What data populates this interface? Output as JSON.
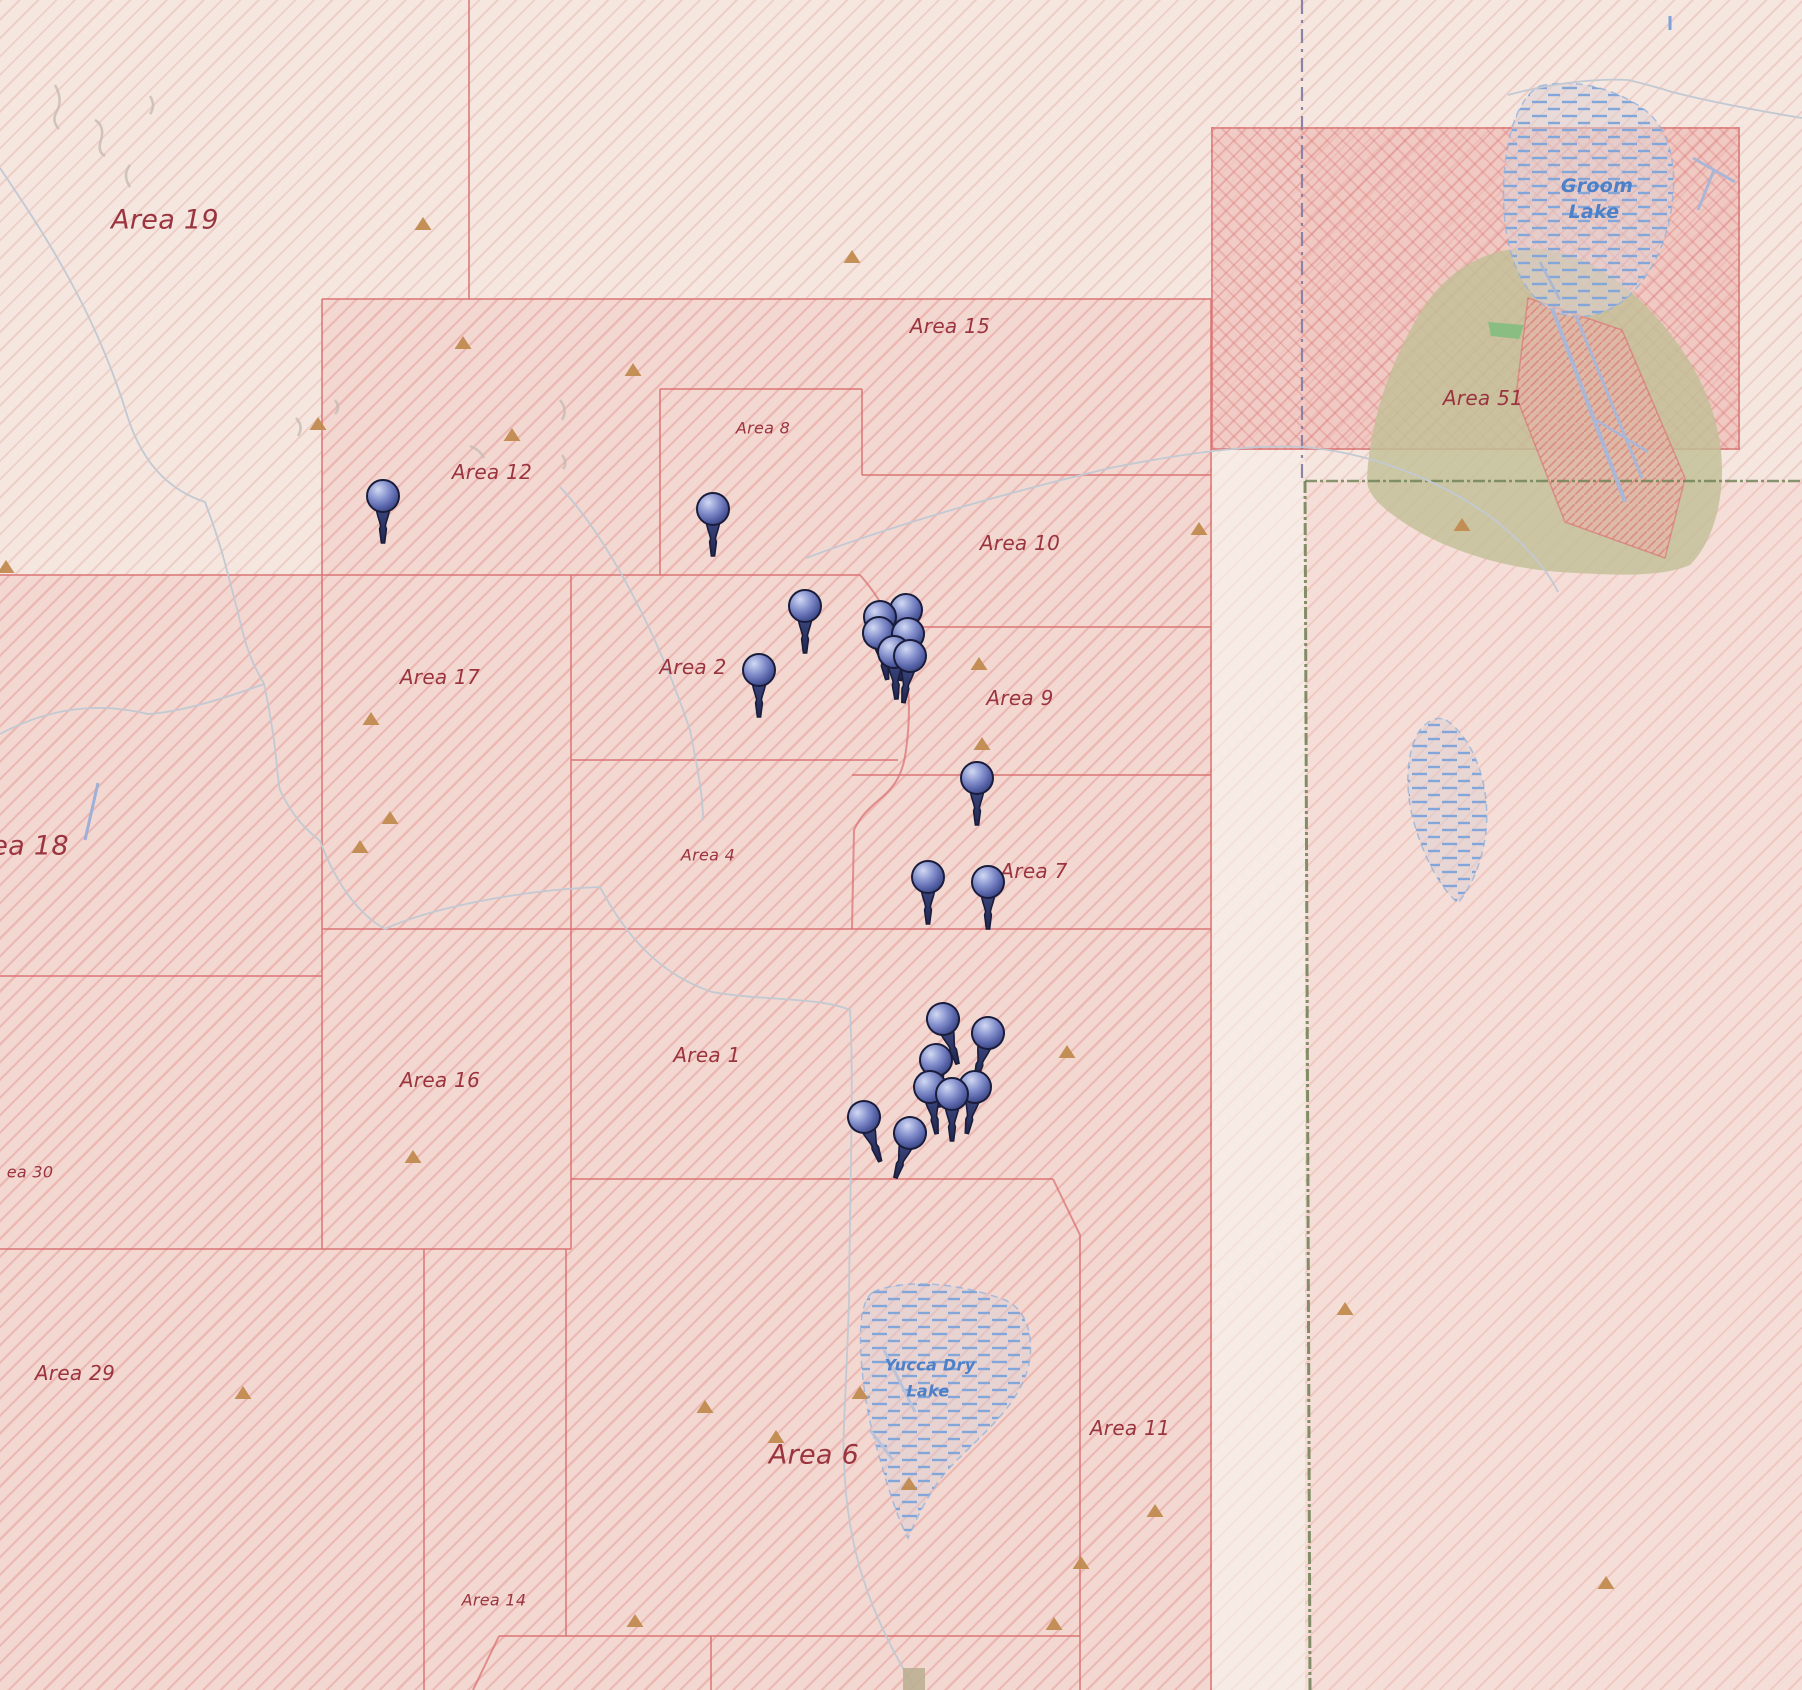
{
  "map": {
    "width": 1802,
    "height": 1690,
    "colors": {
      "label_red": "#9a343f",
      "label_blue": "#4c80c8",
      "border_red": "rgba(216,112,112,0.72)",
      "peak": "#c18b4f",
      "pin_body": "#6b77bb",
      "green_boundary": "#6d7f53",
      "county_boundary": "#8d81a4",
      "road": "#c2c9d2",
      "runway": "#aab6d6",
      "olive_base": "#c2bf97",
      "lake_dash": "#83a6da",
      "squiggle": "#c6bcb2"
    },
    "labels": [
      {
        "id": "area-19",
        "text": "Area 19",
        "x": 165,
        "y": 220,
        "size": "xl",
        "color": "red"
      },
      {
        "id": "area-15",
        "text": "Area 15",
        "x": 950,
        "y": 326,
        "size": "md",
        "color": "red"
      },
      {
        "id": "area-8",
        "text": "Area 8",
        "x": 763,
        "y": 428,
        "size": "sm",
        "color": "red"
      },
      {
        "id": "area-12",
        "text": "Area 12",
        "x": 492,
        "y": 472,
        "size": "md",
        "color": "red"
      },
      {
        "id": "area-51",
        "text": "Area 51",
        "x": 1483,
        "y": 398,
        "size": "md",
        "color": "red"
      },
      {
        "id": "groom-lake-line1",
        "text": "Groom",
        "x": 1597,
        "y": 186,
        "size": "blue-md",
        "color": "blue"
      },
      {
        "id": "groom-lake-line2",
        "text": "Lake",
        "x": 1594,
        "y": 212,
        "size": "blue-md",
        "color": "blue"
      },
      {
        "id": "area-10",
        "text": "Area 10",
        "x": 1020,
        "y": 543,
        "size": "md",
        "color": "red"
      },
      {
        "id": "area-2",
        "text": "Area 2",
        "x": 693,
        "y": 667,
        "size": "md",
        "color": "red"
      },
      {
        "id": "area-17",
        "text": "Area 17",
        "x": 440,
        "y": 677,
        "size": "md",
        "color": "red"
      },
      {
        "id": "area-9",
        "text": "Area 9",
        "x": 1020,
        "y": 698,
        "size": "md",
        "color": "red"
      },
      {
        "id": "area-18",
        "text": "ea 18",
        "x": 30,
        "y": 846,
        "size": "xl",
        "color": "red"
      },
      {
        "id": "area-4",
        "text": "Area 4",
        "x": 708,
        "y": 855,
        "size": "sm",
        "color": "red"
      },
      {
        "id": "area-7",
        "text": "Area 7",
        "x": 1034,
        "y": 871,
        "size": "md",
        "color": "red"
      },
      {
        "id": "area-1",
        "text": "Area 1",
        "x": 707,
        "y": 1055,
        "size": "md",
        "color": "red"
      },
      {
        "id": "area-16",
        "text": "Area 16",
        "x": 440,
        "y": 1080,
        "size": "md",
        "color": "red"
      },
      {
        "id": "area-30",
        "text": "ea 30",
        "x": 30,
        "y": 1172,
        "size": "sm",
        "color": "red"
      },
      {
        "id": "area-29",
        "text": "Area 29",
        "x": 75,
        "y": 1373,
        "size": "md",
        "color": "red"
      },
      {
        "id": "yucca-lake-line1",
        "text": "Yucca Dry",
        "x": 930,
        "y": 1365,
        "size": "blue-sm",
        "color": "blue"
      },
      {
        "id": "yucca-lake-line2",
        "text": "Lake",
        "x": 928,
        "y": 1391,
        "size": "blue-sm",
        "color": "blue"
      },
      {
        "id": "area-11",
        "text": "Area 11",
        "x": 1130,
        "y": 1428,
        "size": "md",
        "color": "red"
      },
      {
        "id": "area-6",
        "text": "Area 6",
        "x": 814,
        "y": 1455,
        "size": "xl",
        "color": "red"
      },
      {
        "id": "area-14",
        "text": "Area 14",
        "x": 494,
        "y": 1600,
        "size": "sm",
        "color": "red"
      }
    ],
    "pins": [
      {
        "x": 383,
        "y": 496,
        "rot": 0
      },
      {
        "x": 713,
        "y": 509,
        "rot": 0
      },
      {
        "x": 805,
        "y": 606,
        "rot": 0
      },
      {
        "x": 759,
        "y": 670,
        "rot": 0
      },
      {
        "x": 880,
        "y": 617,
        "rot": -6
      },
      {
        "x": 906,
        "y": 610,
        "rot": 5
      },
      {
        "x": 879,
        "y": 633,
        "rot": -10
      },
      {
        "x": 908,
        "y": 634,
        "rot": 10
      },
      {
        "x": 894,
        "y": 652,
        "rot": -3
      },
      {
        "x": 910,
        "y": 656,
        "rot": 8
      },
      {
        "x": 977,
        "y": 778,
        "rot": 0
      },
      {
        "x": 928,
        "y": 877,
        "rot": 0
      },
      {
        "x": 988,
        "y": 882,
        "rot": 0
      },
      {
        "x": 943,
        "y": 1019,
        "rot": -18
      },
      {
        "x": 988,
        "y": 1033,
        "rot": 15
      },
      {
        "x": 936,
        "y": 1060,
        "rot": -5
      },
      {
        "x": 930,
        "y": 1087,
        "rot": -8
      },
      {
        "x": 975,
        "y": 1087,
        "rot": 10
      },
      {
        "x": 952,
        "y": 1094,
        "rot": 0
      },
      {
        "x": 864,
        "y": 1117,
        "rot": -20
      },
      {
        "x": 910,
        "y": 1133,
        "rot": 18
      }
    ],
    "peaks": [
      [
        423,
        225
      ],
      [
        318,
        425
      ],
      [
        463,
        344
      ],
      [
        512,
        436
      ],
      [
        633,
        371
      ],
      [
        852,
        258
      ],
      [
        6,
        568
      ],
      [
        371,
        720
      ],
      [
        390,
        819
      ],
      [
        360,
        848
      ],
      [
        979,
        665
      ],
      [
        982,
        745
      ],
      [
        1199,
        530
      ],
      [
        1462,
        526
      ],
      [
        1067,
        1053
      ],
      [
        413,
        1158
      ],
      [
        243,
        1394
      ],
      [
        705,
        1408
      ],
      [
        776,
        1438
      ],
      [
        860,
        1394
      ],
      [
        909,
        1485
      ],
      [
        635,
        1622
      ],
      [
        1081,
        1564
      ],
      [
        1054,
        1625
      ],
      [
        1155,
        1512
      ],
      [
        1345,
        1310
      ],
      [
        1606,
        1584
      ]
    ],
    "borders": [
      "M469,0 L469,299",
      "M322,299 L1211,299",
      "M322,299 L322,1249",
      "M660,389 L862,389",
      "M660,389 L660,575",
      "M862,389 L862,475",
      "M862,475 L1211,475",
      "M0,575 L860,575",
      "M571,575 L571,1249",
      "M860,575 C900,620 916,680 906,750 C900,800 870,795 854,830 L852,929",
      "M904,627 L1211,627",
      "M852,775 L1211,775",
      "M571,760 L898,760",
      "M322,929 L1211,929",
      "M0,976 L322,976",
      "M571,1179 L1053,1179",
      "M1053,1179 L1080,1235 L1080,1690",
      "M0,1249 L571,1249",
      "M424,1249 L424,1690",
      "M566,1249 L566,1636",
      "M499,1636 L1080,1636",
      "M499,1636 L473,1690",
      "M711,1636 L711,1690",
      "M1211,299 L1211,1690"
    ],
    "boundaries": {
      "county_dash": "M1302,0 L1302,481",
      "green_vertical": "M1305,481 L1310,1690",
      "green_horizontal": "M1305,481 L1802,481"
    },
    "olive_base_area": "M1367,478 C1370,420 1390,360 1425,305 C1455,262 1500,242 1548,250 C1595,258 1640,292 1675,340 C1705,380 1722,425 1722,470 C1722,510 1710,545 1690,565 C1660,578 1610,575 1560,572 C1500,568 1440,548 1400,520 C1378,505 1366,492 1367,478 Z",
    "green_sliver": "M1488,322 L1524,325 L1519,339 L1491,336 Z",
    "runway_area": "M1528,298 L1622,330 L1685,478 L1665,558 L1565,522 L1516,396 Z",
    "runways": [
      {
        "d": "M1552,308 L1625,502",
        "w": 4
      },
      {
        "d": "M1576,316 L1642,478",
        "w": 3
      },
      {
        "d": "M1596,420 L1648,452",
        "w": 2.5
      },
      {
        "d": "M1540,262 L1560,300",
        "w": 2.5
      },
      {
        "d": "M1693,158 L1735,182",
        "w": 3
      },
      {
        "d": "M1714,170 L1698,210",
        "w": 3
      }
    ],
    "lakes": {
      "groom": "M1540,86 C1575,78 1615,88 1645,110 C1668,128 1676,160 1673,195 C1670,235 1655,270 1630,295 C1605,318 1575,322 1552,310 C1530,300 1512,270 1506,230 C1500,190 1505,140 1518,112 C1526,96 1532,90 1540,86 Z",
      "yucca": "M873,1292 C905,1278 960,1283 1005,1300 C1028,1310 1035,1340 1028,1368 C1018,1405 985,1432 955,1462 C935,1482 920,1510 908,1538 C898,1520 885,1480 872,1430 C862,1390 858,1340 862,1315 C865,1300 868,1296 873,1292 Z",
      "pond": "M1446,720 C1468,735 1482,765 1486,800 C1490,840 1478,878 1458,903 C1440,888 1422,855 1412,815 C1404,780 1408,748 1420,730 C1428,720 1438,716 1446,720 Z"
    },
    "roads": [
      "M0,168 C45,235 95,310 128,418 C145,470 175,492 205,502 C225,555 230,585 238,612 C248,660 258,672 264,684 C278,750 276,772 280,790 C295,822 310,832 320,841 C338,888 360,915 385,929 C430,908 520,890 600,887 C628,940 662,975 712,992 C765,1001 820,997 850,1010 C854,1080 850,1180 849,1300 C846,1400 842,1440 844,1460 C846,1540 866,1610 915,1688",
      "M264,684 C220,700 180,712 148,714 C110,705 60,702 0,734",
      "M806,558 C900,523 1010,492 1110,468 C1180,454 1250,444 1302,447 C1370,452 1440,480 1492,518 C1520,540 1545,565 1558,592",
      "M560,487 C610,540 660,640 690,730 C700,780 703,800 703,820",
      "M1508,95 C1545,85 1590,78 1628,80 C1645,84 1660,88 1672,92 C1715,103 1760,111 1802,118"
    ],
    "yucca_strips": [
      "M884,1350 L915,1412",
      "M870,1430 L893,1460"
    ],
    "squiggles": [
      "M55,85 q8,14 2,26 q-6,10 2,18",
      "M95,120 q10,6 6,20 q-4,12 4,16",
      "M130,165 q-8,10 0,22",
      "M150,96 q6,10 0,18",
      "M296,418 q8,8 2,18",
      "M335,400 q6,8 0,14",
      "M470,446 q10,4 14,12",
      "M560,400 q8,10 2,20",
      "M562,455 q6,8 1,14"
    ],
    "extras": {
      "blue_stroke": "M98,783 L85,840",
      "blue_tick": "M1670,16 L1670,30",
      "tan_patch": {
        "x": 903,
        "y": 1668,
        "w": 22,
        "h": 22
      }
    }
  }
}
